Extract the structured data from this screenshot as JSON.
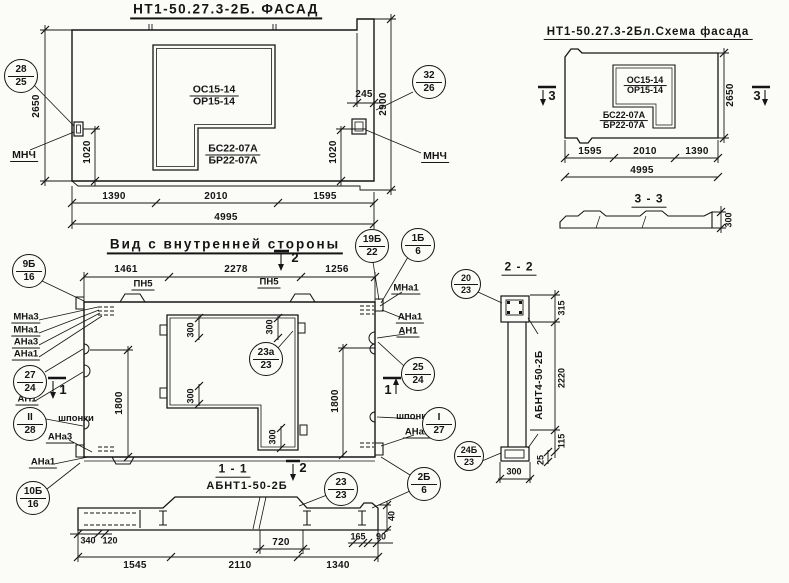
{
  "titles": {
    "facade": "НТ1-50.27.3-2Б. ФАСАД",
    "schema": "НТ1-50.27.3-2Бл.Схема фасада",
    "inner_view": "Вид с внутренней стороны",
    "section_1_1": "1 - 1",
    "section_1_1_mark": "АБНТ1-50-2Б",
    "section_2_2": "2 - 2",
    "section_2_2_mark": "АБНТ4-50-2Б",
    "section_3_3": "3 - 3"
  },
  "marks": {
    "window_sash": "ОС15-14",
    "window_frame": "ОР15-14",
    "block_top": "БС22-07А",
    "block_bottom": "БР22-07А",
    "mnch": "МНЧ",
    "pn5": "ПН5",
    "mna3": "МНа3",
    "mna1": "МНа1",
    "ana3": "АНа3",
    "ana1": "АНа1",
    "an1": "АН1",
    "shponki": "шпонки"
  },
  "cuts": {
    "one": "1",
    "two": "2",
    "three": "3"
  },
  "callouts": {
    "c28_25": {
      "top": "28",
      "bottom": "25"
    },
    "c32_26": {
      "top": "32",
      "bottom": "26"
    },
    "c19b_22": {
      "top": "19Б",
      "bottom": "22"
    },
    "c1b_6": {
      "top": "1Б",
      "bottom": "6"
    },
    "c9b_16": {
      "top": "9Б",
      "bottom": "16"
    },
    "c27_24": {
      "top": "27",
      "bottom": "24"
    },
    "cII_28": {
      "top": "II",
      "bottom": "28"
    },
    "c10b_16": {
      "top": "10Б",
      "bottom": "16"
    },
    "c25_24": {
      "top": "25",
      "bottom": "24"
    },
    "cI_27": {
      "top": "I",
      "bottom": "27"
    },
    "c2b_6": {
      "top": "2Б",
      "bottom": "6"
    },
    "c23a_23": {
      "top": "23а",
      "bottom": "23"
    },
    "c23_23": {
      "top": "23",
      "bottom": "23"
    },
    "c20_23": {
      "top": "20",
      "bottom": "23"
    },
    "c24b_23": {
      "top": "24Б",
      "bottom": "23"
    }
  },
  "dims": {
    "facade": {
      "height_left": "2650",
      "height_right": "2900",
      "rib": "245",
      "anchor_left": "1020",
      "anchor_right": "1020",
      "w1": "1390",
      "w2": "2010",
      "w3": "1595",
      "total": "4995"
    },
    "schema": {
      "height": "2650",
      "w1": "1595",
      "w2": "2010",
      "w3": "1390",
      "total": "4995"
    },
    "inner": {
      "t1": "1461",
      "t2": "2278",
      "t3": "1256",
      "height": "1800",
      "frame": "300"
    },
    "s11": {
      "a": "340",
      "b": "120",
      "mid": "720",
      "b1": "1545",
      "b2": "2110",
      "b3": "1340",
      "r1": "165",
      "r2": "90",
      "h": "40"
    },
    "s22": {
      "top": "315",
      "body": "2220",
      "low": "115",
      "off": "25",
      "width": "300"
    },
    "s33": {
      "thickness": "300"
    }
  }
}
